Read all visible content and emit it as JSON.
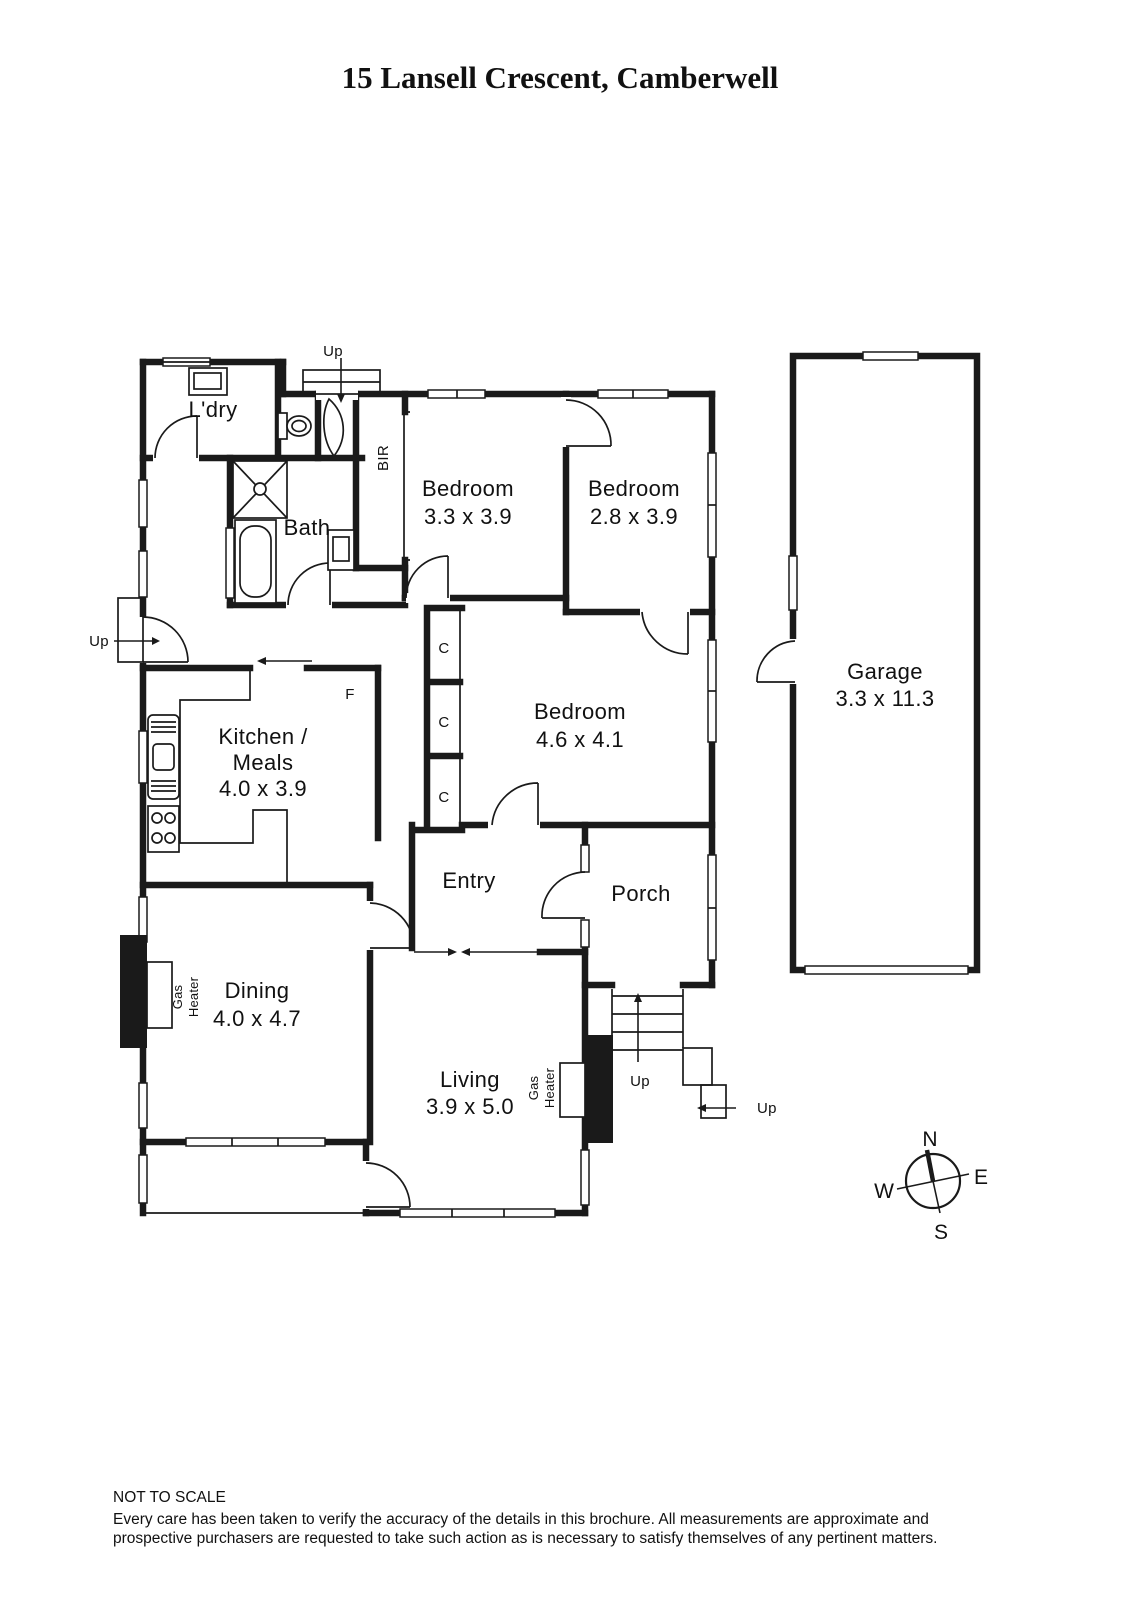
{
  "title": "15 Lansell Crescent, Camberwell",
  "rooms": {
    "laundry": {
      "label": "L'dry"
    },
    "bath": {
      "label": "Bath"
    },
    "bir": {
      "label": "BIR"
    },
    "bedroom1": {
      "name": "Bedroom",
      "dims": "3.3 x 3.9"
    },
    "bedroom2": {
      "name": "Bedroom",
      "dims": "2.8 x 3.9"
    },
    "bedroom3": {
      "name": "Bedroom",
      "dims": "4.6 x 4.1"
    },
    "kitchen": {
      "line1": "Kitchen /",
      "line2": "Meals",
      "dims": "4.0 x 3.9"
    },
    "entry": {
      "label": "Entry"
    },
    "porch": {
      "label": "Porch"
    },
    "dining": {
      "name": "Dining",
      "dims": "4.0 x 4.7"
    },
    "living": {
      "name": "Living",
      "dims": "3.9 x 5.0"
    },
    "garage": {
      "name": "Garage",
      "dims": "3.3 x 11.3"
    }
  },
  "annotations": {
    "closet": "C",
    "fridge": "F",
    "gas": "Gas",
    "heater": "Heater",
    "up": "Up"
  },
  "compass": {
    "north": "N",
    "south": "S",
    "east": "E",
    "west": "W"
  },
  "footer": {
    "scale_note": "NOT TO SCALE",
    "disclaimer_line1": "Every care has been taken to verify the accuracy of the details in this brochure. All measurements are approximate and",
    "disclaimer_line2": "prospective purchasers are requested to take such action as is necessary to satisfy themselves of any pertinent matters."
  },
  "colors": {
    "wall": "#1a1a1a",
    "text": "#111111",
    "background": "#ffffff"
  }
}
